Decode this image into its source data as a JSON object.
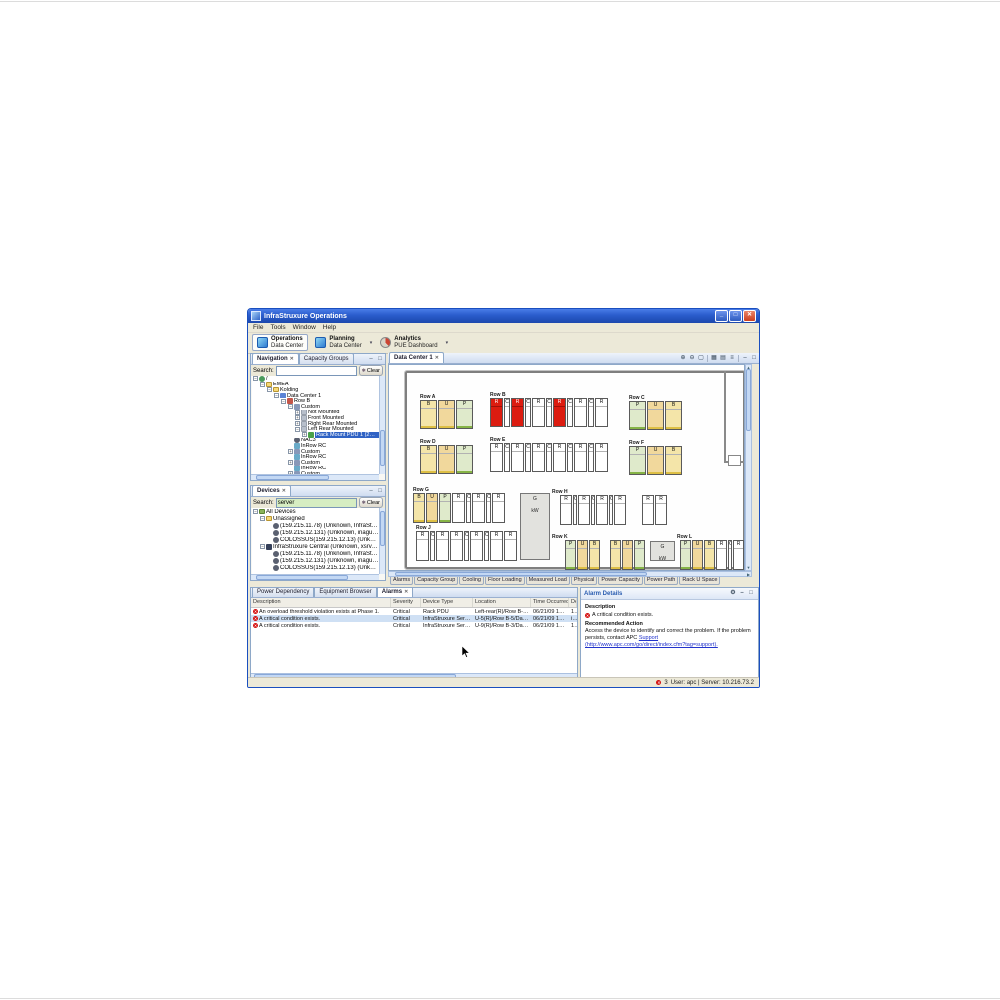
{
  "window": {
    "title": "InfraStruxure Operations"
  },
  "menu": [
    "File",
    "Tools",
    "Window",
    "Help"
  ],
  "toolbar": {
    "perspectives": [
      {
        "title": "Operations",
        "subtitle": "Data Center",
        "icon": "operations-icon",
        "active": true,
        "dropdown": false
      },
      {
        "title": "Planning",
        "subtitle": "Data Center",
        "icon": "planning-icon",
        "active": false,
        "dropdown": true
      },
      {
        "title": "Analytics",
        "subtitle": "PUE Dashboard",
        "icon": "analytics-icon",
        "active": false,
        "dropdown": true
      }
    ]
  },
  "navigation": {
    "tabs": [
      {
        "label": "Navigation",
        "active": true,
        "closable": true
      },
      {
        "label": "Capacity Groups",
        "active": false,
        "closable": false
      }
    ],
    "panel_icons": [
      "minimize-icon",
      "maximize-icon"
    ],
    "search_label": "Search:",
    "search_value": "",
    "clear_label": "Clear",
    "tree": [
      {
        "d": 0,
        "exp": "-",
        "icon": "server-root-icon",
        "label": "/",
        "sel": false
      },
      {
        "d": 1,
        "exp": "-",
        "icon": "folder-icon",
        "label": "EMEA",
        "sel": false
      },
      {
        "d": 2,
        "exp": "-",
        "icon": "folder-icon",
        "label": "Kolding",
        "sel": false
      },
      {
        "d": 3,
        "exp": "-",
        "icon": "datacenter-icon",
        "label": "Data Center 1",
        "sel": false
      },
      {
        "d": 4,
        "exp": "-",
        "icon": "row-icon",
        "label": "Row B",
        "sel": false
      },
      {
        "d": 5,
        "exp": "-",
        "icon": "rack-icon",
        "label": "Custom",
        "sel": false
      },
      {
        "d": 6,
        "exp": "+",
        "icon": "mount-icon",
        "label": "Not Mounted",
        "sel": false
      },
      {
        "d": 6,
        "exp": "+",
        "icon": "mount-icon",
        "label": "Front Mounted",
        "sel": false
      },
      {
        "d": 6,
        "exp": "+",
        "icon": "mount-icon",
        "label": "Right Rear Mounted",
        "sel": false
      },
      {
        "d": 6,
        "exp": "-",
        "icon": "mount-icon",
        "label": "Left Rear Mounted",
        "sel": false
      },
      {
        "d": 7,
        "exp": "+",
        "icon": "pdu-icon",
        "label": "Rack Mount PDU 1 (209.218.33.24)",
        "sel": true
      },
      {
        "d": 5,
        "exp": null,
        "icon": "device-icon",
        "label": "NAC3",
        "sel": false
      },
      {
        "d": 5,
        "exp": null,
        "icon": "inrow-icon",
        "label": "InRow RC",
        "sel": false
      },
      {
        "d": 5,
        "exp": "+",
        "icon": "rack-icon",
        "label": "Custom",
        "sel": false
      },
      {
        "d": 5,
        "exp": null,
        "icon": "inrow-icon",
        "label": "InRow RC",
        "sel": false
      },
      {
        "d": 5,
        "exp": "+",
        "icon": "rack-icon",
        "label": "Custom",
        "sel": false
      },
      {
        "d": 5,
        "exp": null,
        "icon": "inrow-icon",
        "label": "InRow RC",
        "sel": false
      },
      {
        "d": 5,
        "exp": "+",
        "icon": "rack-icon",
        "label": "Custom",
        "sel": false
      }
    ]
  },
  "devices": {
    "tabs": [
      {
        "label": "Devices",
        "active": true,
        "closable": true
      }
    ],
    "panel_icons": [
      "minimize-icon",
      "maximize-icon"
    ],
    "search_label": "Search:",
    "search_value": "server",
    "clear_label": "Clear",
    "tree": [
      {
        "d": 0,
        "exp": "-",
        "icon": "devices-folder-icon",
        "label": "All Devices",
        "sel": false
      },
      {
        "d": 1,
        "exp": "-",
        "icon": "folder-icon",
        "label": "Unassigned",
        "sel": false
      },
      {
        "d": 2,
        "exp": null,
        "icon": "device-icon",
        "label": "(159.215.11.78) (Unknown, InfraStruxure Server)",
        "sel": false
      },
      {
        "d": 2,
        "exp": null,
        "icon": "device-icon",
        "label": "(159.215.12.131) (Unknown, inagua.ame.apc.com, InfraStr...",
        "sel": false
      },
      {
        "d": 2,
        "exp": null,
        "icon": "device-icon",
        "label": "COLOSSUS(159.215.12.13) (Unknown, colossus.ame.apc.c...",
        "sel": false
      },
      {
        "d": 1,
        "exp": "-",
        "icon": "server-icon",
        "label": "InfraStruxure Central (Unknown, xsrv-02.smea.apc.com, Inf...",
        "sel": false
      },
      {
        "d": 2,
        "exp": null,
        "icon": "device-icon",
        "label": "(159.215.11.78) (Unknown, InfraStruxure Server)",
        "sel": false
      },
      {
        "d": 2,
        "exp": null,
        "icon": "device-icon",
        "label": "(159.215.12.131) (Unknown, inagua.ame.apc.com, InfraStr...",
        "sel": false
      },
      {
        "d": 2,
        "exp": null,
        "icon": "device-icon",
        "label": "COLOSSUS(159.215.12.13) (Unknown, colossus.ame.apc.c...",
        "sel": false
      }
    ]
  },
  "editor": {
    "tabs": [
      {
        "label": "Data Center 1",
        "active": true,
        "closable": true
      }
    ],
    "toolbar_icons": [
      "zoom-in-icon",
      "zoom-out-icon",
      "fit-icon",
      "sep",
      "grid-icon",
      "layers-icon",
      "list-icon",
      "sep",
      "minimize-icon",
      "maximize-icon"
    ],
    "page_tabs": [
      "Alarms",
      "Capacity Group",
      "Cooling",
      "Floor Loading",
      "Measured Load",
      "Physical",
      "Power Capacity",
      "Power Path",
      "Rack U Space"
    ],
    "colors": {
      "alarm_rack": "#dc1c10",
      "rack_yellow": "#f4e5a9",
      "rack_orange": "#f1d89c",
      "rack_green": "#dfeacb"
    },
    "floor": {
      "rows": [
        {
          "name": "Row A",
          "x": 31,
          "y": 30,
          "h": 29,
          "units": [
            {
              "l": "B",
              "c": "y",
              "w": 17
            },
            {
              "l": "U",
              "c": "o",
              "w": 17
            },
            {
              "l": "P",
              "c": "g",
              "w": 17
            }
          ]
        },
        {
          "name": "Row B",
          "x": 101,
          "y": 28,
          "h": 29,
          "units": [
            {
              "l": "R",
              "c": "r",
              "w": 13
            },
            {
              "l": "C",
              "c": "w",
              "w": 6
            },
            {
              "l": "R",
              "c": "r",
              "w": 13
            },
            {
              "l": "C",
              "c": "w",
              "w": 6
            },
            {
              "l": "R",
              "c": "w",
              "w": 13
            },
            {
              "l": "C",
              "c": "w",
              "w": 6
            },
            {
              "l": "R",
              "c": "r",
              "w": 13
            },
            {
              "l": "C",
              "c": "w",
              "w": 6
            },
            {
              "l": "R",
              "c": "w",
              "w": 13
            },
            {
              "l": "C",
              "c": "w",
              "w": 6
            },
            {
              "l": "R",
              "c": "w",
              "w": 13
            }
          ]
        },
        {
          "name": "Row C",
          "x": 240,
          "y": 31,
          "h": 29,
          "units": [
            {
              "l": "P",
              "c": "g",
              "w": 17
            },
            {
              "l": "U",
              "c": "o",
              "w": 17
            },
            {
              "l": "B",
              "c": "y",
              "w": 17
            }
          ]
        },
        {
          "name": "Row D",
          "x": 31,
          "y": 75,
          "h": 29,
          "units": [
            {
              "l": "B",
              "c": "y",
              "w": 17
            },
            {
              "l": "U",
              "c": "o",
              "w": 17
            },
            {
              "l": "P",
              "c": "g",
              "w": 17
            }
          ]
        },
        {
          "name": "Row E",
          "x": 101,
          "y": 73,
          "h": 29,
          "units": [
            {
              "l": "R",
              "c": "w",
              "w": 13
            },
            {
              "l": "C",
              "c": "w",
              "w": 6
            },
            {
              "l": "R",
              "c": "w",
              "w": 13
            },
            {
              "l": "C",
              "c": "w",
              "w": 6
            },
            {
              "l": "R",
              "c": "w",
              "w": 13
            },
            {
              "l": "C",
              "c": "w",
              "w": 6
            },
            {
              "l": "R",
              "c": "w",
              "w": 13
            },
            {
              "l": "C",
              "c": "w",
              "w": 6
            },
            {
              "l": "R",
              "c": "w",
              "w": 13
            },
            {
              "l": "C",
              "c": "w",
              "w": 6
            },
            {
              "l": "R",
              "c": "w",
              "w": 13
            }
          ]
        },
        {
          "name": "Row F",
          "x": 240,
          "y": 76,
          "h": 29,
          "units": [
            {
              "l": "P",
              "c": "g",
              "w": 17
            },
            {
              "l": "U",
              "c": "o",
              "w": 17
            },
            {
              "l": "B",
              "c": "y",
              "w": 17
            }
          ]
        },
        {
          "name": "Row G",
          "x": 24,
          "y": 123,
          "h": 30,
          "units": [
            {
              "l": "B",
              "c": "y",
              "w": 12
            },
            {
              "l": "U",
              "c": "o",
              "w": 12
            },
            {
              "l": "P",
              "c": "g",
              "w": 12
            },
            {
              "l": "R",
              "c": "w",
              "w": 13
            },
            {
              "l": "C",
              "c": "w",
              "w": 5
            },
            {
              "l": "R",
              "c": "w",
              "w": 13
            },
            {
              "l": "C",
              "c": "w",
              "w": 5
            },
            {
              "l": "R",
              "c": "w",
              "w": 13
            }
          ]
        },
        {
          "name": "Row H",
          "x": 163,
          "y": 125,
          "h": 30,
          "units": [
            {
              "c": "gap",
              "w": 7
            },
            {
              "l": "R",
              "c": "w",
              "w": 12
            },
            {
              "l": "C",
              "c": "w",
              "w": 4
            },
            {
              "l": "R",
              "c": "w",
              "w": 12
            },
            {
              "l": "C",
              "c": "w",
              "w": 4
            },
            {
              "l": "R",
              "c": "w",
              "w": 12
            },
            {
              "l": "C",
              "c": "w",
              "w": 4
            },
            {
              "l": "R",
              "c": "w",
              "w": 12
            },
            {
              "c": "gap",
              "w": 14
            },
            {
              "l": "R",
              "c": "w",
              "w": 12
            },
            {
              "l": "R",
              "c": "w",
              "w": 12
            }
          ]
        },
        {
          "name": "Row J",
          "x": 27,
          "y": 161,
          "h": 30,
          "units": [
            {
              "l": "R",
              "c": "w",
              "w": 13
            },
            {
              "l": "C",
              "c": "w",
              "w": 5
            },
            {
              "l": "R",
              "c": "w",
              "w": 13
            },
            {
              "l": "R",
              "c": "w",
              "w": 13
            },
            {
              "l": "C",
              "c": "w",
              "w": 5
            },
            {
              "l": "R",
              "c": "w",
              "w": 13
            },
            {
              "l": "C",
              "c": "w",
              "w": 5
            },
            {
              "l": "R",
              "c": "w",
              "w": 13
            },
            {
              "l": "R",
              "c": "w",
              "w": 13
            }
          ]
        },
        {
          "name": "Row K",
          "x": 163,
          "y": 170,
          "h": 30,
          "units": [
            {
              "c": "gap",
              "w": 12
            },
            {
              "l": "P",
              "c": "g",
              "w": 11
            },
            {
              "l": "U",
              "c": "o",
              "w": 11
            },
            {
              "l": "B",
              "c": "y",
              "w": 11
            },
            {
              "c": "gap",
              "w": 8
            },
            {
              "l": "B",
              "c": "y",
              "w": 11
            },
            {
              "l": "U",
              "c": "o",
              "w": 11
            },
            {
              "l": "P",
              "c": "g",
              "w": 11
            }
          ]
        },
        {
          "name": "Row L",
          "x": 288,
          "y": 170,
          "h": 30,
          "units": [
            {
              "c": "gap",
              "w": 2
            },
            {
              "l": "P",
              "c": "g",
              "w": 11
            },
            {
              "l": "U",
              "c": "o",
              "w": 11
            },
            {
              "l": "B",
              "c": "y",
              "w": 11
            },
            {
              "l": "R",
              "c": "w",
              "w": 11
            },
            {
              "l": "C",
              "c": "w",
              "w": 4
            },
            {
              "l": "R",
              "c": "w",
              "w": 11
            }
          ]
        }
      ],
      "pods": [
        {
          "x": 131,
          "y": 128,
          "w": 30,
          "h": 67,
          "label": "G",
          "sub": "kW"
        },
        {
          "x": 261,
          "y": 176,
          "w": 25,
          "h": 20,
          "label": "G",
          "sub": "kW"
        }
      ]
    }
  },
  "bottom": {
    "tabs": [
      {
        "label": "Power Dependency",
        "active": false,
        "closable": false
      },
      {
        "label": "Equipment Browser",
        "active": false,
        "closable": false
      },
      {
        "label": "Alarms",
        "active": true,
        "closable": true
      }
    ],
    "columns": [
      "Description",
      "Severity",
      "Device Type",
      "Location",
      "Time Occurred",
      "De"
    ],
    "rows": [
      {
        "description": "An overload threshold violation exists at Phase 1.",
        "severity": "Critical",
        "device_type": "Rack PDU",
        "location": "Left-rear(R)/Row B-1/Data Center 1/K...",
        "time": "06/21/09 13:36:33",
        "dev": "159",
        "sel": false
      },
      {
        "description": "A critical condition exists.",
        "severity": "Critical",
        "device_type": "InfraStruxure Server",
        "location": "U-5(R)/Row B-5/Data Center 1/Koldin...",
        "time": "06/21/09 13:36:28",
        "dev": "inag",
        "sel": true
      },
      {
        "description": "A critical condition exists.",
        "severity": "Critical",
        "device_type": "InfraStruxure Server",
        "location": "U-9(R)/Row B-3/Data Center 1/Koldin...",
        "time": "06/21/09 13:36:28",
        "dev": "159",
        "sel": false
      }
    ]
  },
  "alarm_details": {
    "title": "Alarm Details",
    "panel_icons": [
      "settings-icon",
      "minimize-icon",
      "maximize-icon"
    ],
    "description_label": "Description",
    "description": "A critical condition exists.",
    "action_label": "Recommended Action",
    "action_text": "Access the device to identify and correct the problem. If the problem persists, contact APC",
    "action_link": "Support (http://www.apc.com/go/direct/index.cfm?tag=support)."
  },
  "status": {
    "alarm_count": "3",
    "user_server": "User: apc | Server: 10.216.73.2"
  }
}
